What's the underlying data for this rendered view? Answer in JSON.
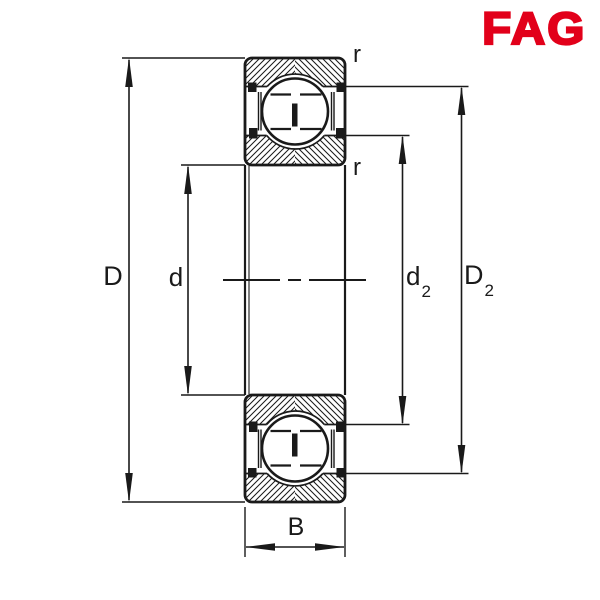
{
  "logo": {
    "text": "FAG",
    "color": "#E2001A"
  },
  "drawing": {
    "type": "bearing-cross-section",
    "description": "Sectional drawing of a shielded deep groove ball bearing",
    "dimension_labels": {
      "outer_diameter": "D",
      "bore_diameter": "d",
      "inner_shoulder_diameter": {
        "base": "d",
        "sub": "2"
      },
      "outer_shoulder_diameter": {
        "base": "D",
        "sub": "2"
      },
      "width": "B",
      "corner_radius_top": "r",
      "corner_radius_bottom": "r"
    },
    "colors": {
      "line": "#1a1a1a",
      "background": "#ffffff",
      "logo_red": "#E2001A"
    }
  }
}
